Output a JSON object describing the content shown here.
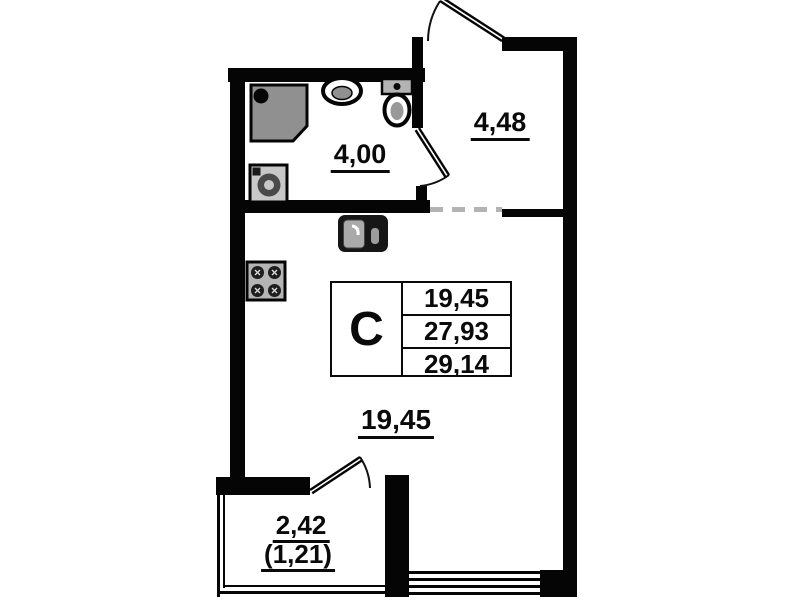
{
  "stamp": {
    "type_label": "С",
    "values": [
      "19,45",
      "27,93",
      "29,14"
    ]
  },
  "rooms": {
    "bathroom": {
      "area": "4,00"
    },
    "hallway": {
      "area": "4,48"
    },
    "living_room": {
      "area": "19,45"
    },
    "balcony": {
      "area": "2,42",
      "area_coefficient": "(1,21)"
    }
  },
  "fixtures": [
    "shower-cabin",
    "washing-machine",
    "wash-basin",
    "toilet",
    "kitchen-sink",
    "stove"
  ],
  "colors": {
    "wall": "#050505",
    "fixture_gray": "#909090",
    "dashed_boundary": "#b3b3b3",
    "background": "#ffffff"
  }
}
